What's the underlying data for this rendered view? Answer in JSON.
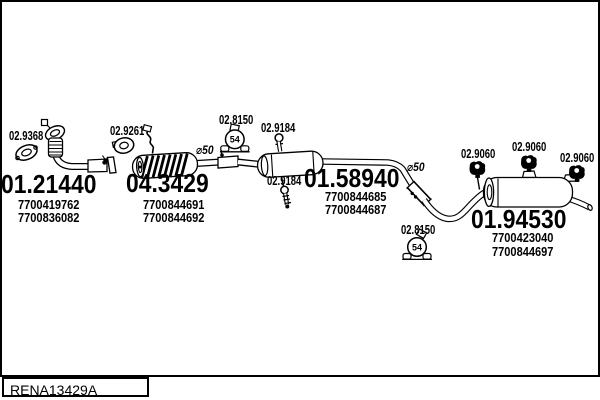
{
  "footer": {
    "drawing_code": "RENA13429A"
  },
  "assemblies": {
    "front_pipe": {
      "code": "01.21440",
      "part_numbers": [
        "7700419762",
        "7700836082"
      ]
    },
    "catalyst": {
      "code": "04.3429",
      "part_numbers": [
        "7700844691",
        "7700844692"
      ]
    },
    "centre_muffler": {
      "code": "01.58940",
      "part_numbers": [
        "7700844685",
        "7700844687"
      ]
    },
    "rear_muffler": {
      "code": "01.94530",
      "part_numbers": [
        "7700423040",
        "7700844697"
      ]
    }
  },
  "fittings": {
    "front_gasket": "02.9368",
    "cat_gasket": "02.9261",
    "clamp_front": "02.8150",
    "clamp_rear": "02.8150",
    "clamp_size": "54",
    "hanger_pin_top": "02.9184",
    "hanger_pin_bottom": "02.9184",
    "rubber_mount_1": "02.9060",
    "rubber_mount_2": "02.9060",
    "rubber_mount_3": "02.9060",
    "pipe_dia_mid": "⌀50",
    "pipe_dia_rear": "⌀50"
  }
}
